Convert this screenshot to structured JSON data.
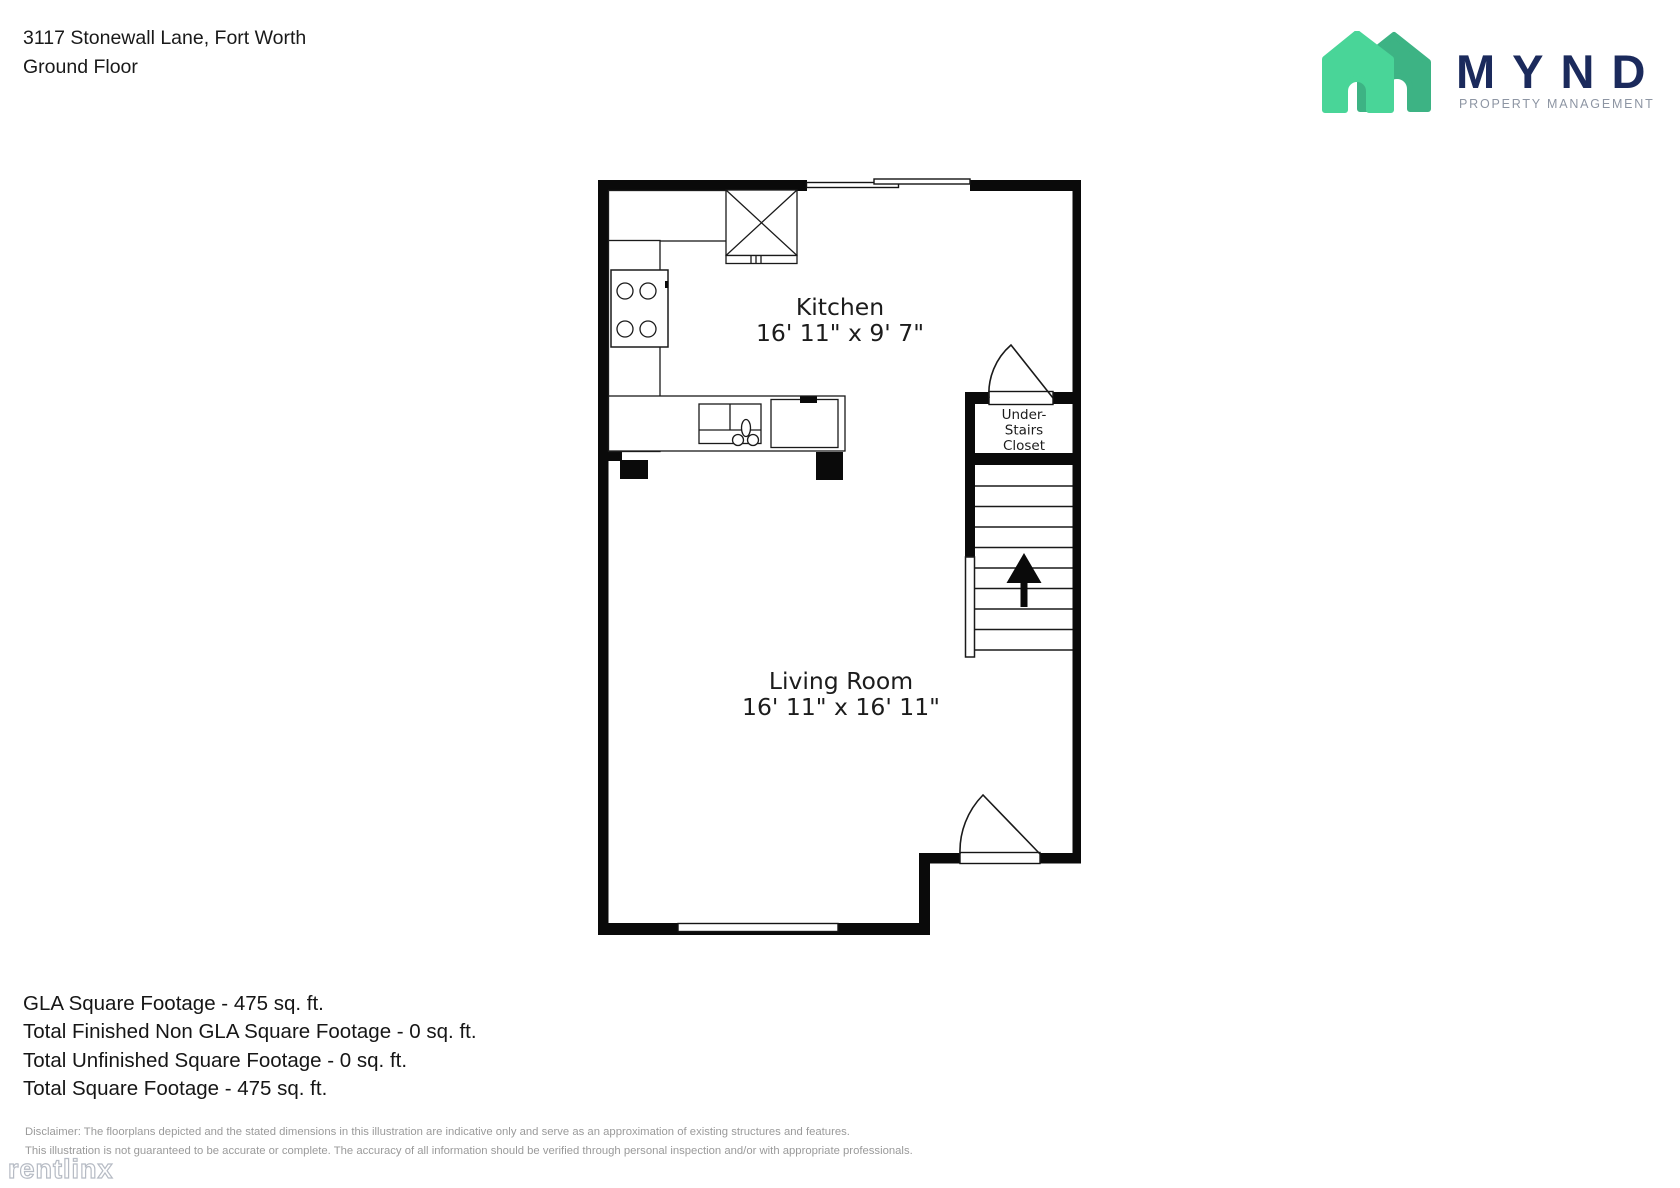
{
  "header": {
    "address": "3117 Stonewall Lane, Fort Worth",
    "floor": "Ground Floor"
  },
  "logo": {
    "brand": "MYND",
    "subtitle": "PROPERTY MANAGEMENT",
    "house_front_color": "#49d598",
    "house_back_color": "#3db384",
    "brand_color": "#1b2a5c",
    "subtitle_color": "#8d95a3"
  },
  "floorplan": {
    "kitchen": {
      "name": "Kitchen",
      "dims": "16' 11\" x 9' 7\""
    },
    "living": {
      "name": "Living Room",
      "dims": "16' 11\" x 16' 11\""
    },
    "closet": {
      "line1": "Under-",
      "line2": "Stairs",
      "line3": "Closet"
    }
  },
  "footer": {
    "summary": [
      "GLA Square Footage - 475 sq. ft.",
      "Total Finished Non GLA Square Footage - 0 sq. ft.",
      "Total Unfinished Square Footage - 0 sq. ft.",
      "Total Square Footage - 475 sq. ft."
    ],
    "disclaimer": [
      "Disclaimer: The floorplans depicted and the stated dimensions in this illustration are indicative only and serve as an approximation of existing structures and features.",
      "This illustration is not guaranteed to be accurate or complete. The accuracy of all information should be verified through personal inspection and/or with appropriate professionals."
    ],
    "watermark": "rentlinx"
  }
}
